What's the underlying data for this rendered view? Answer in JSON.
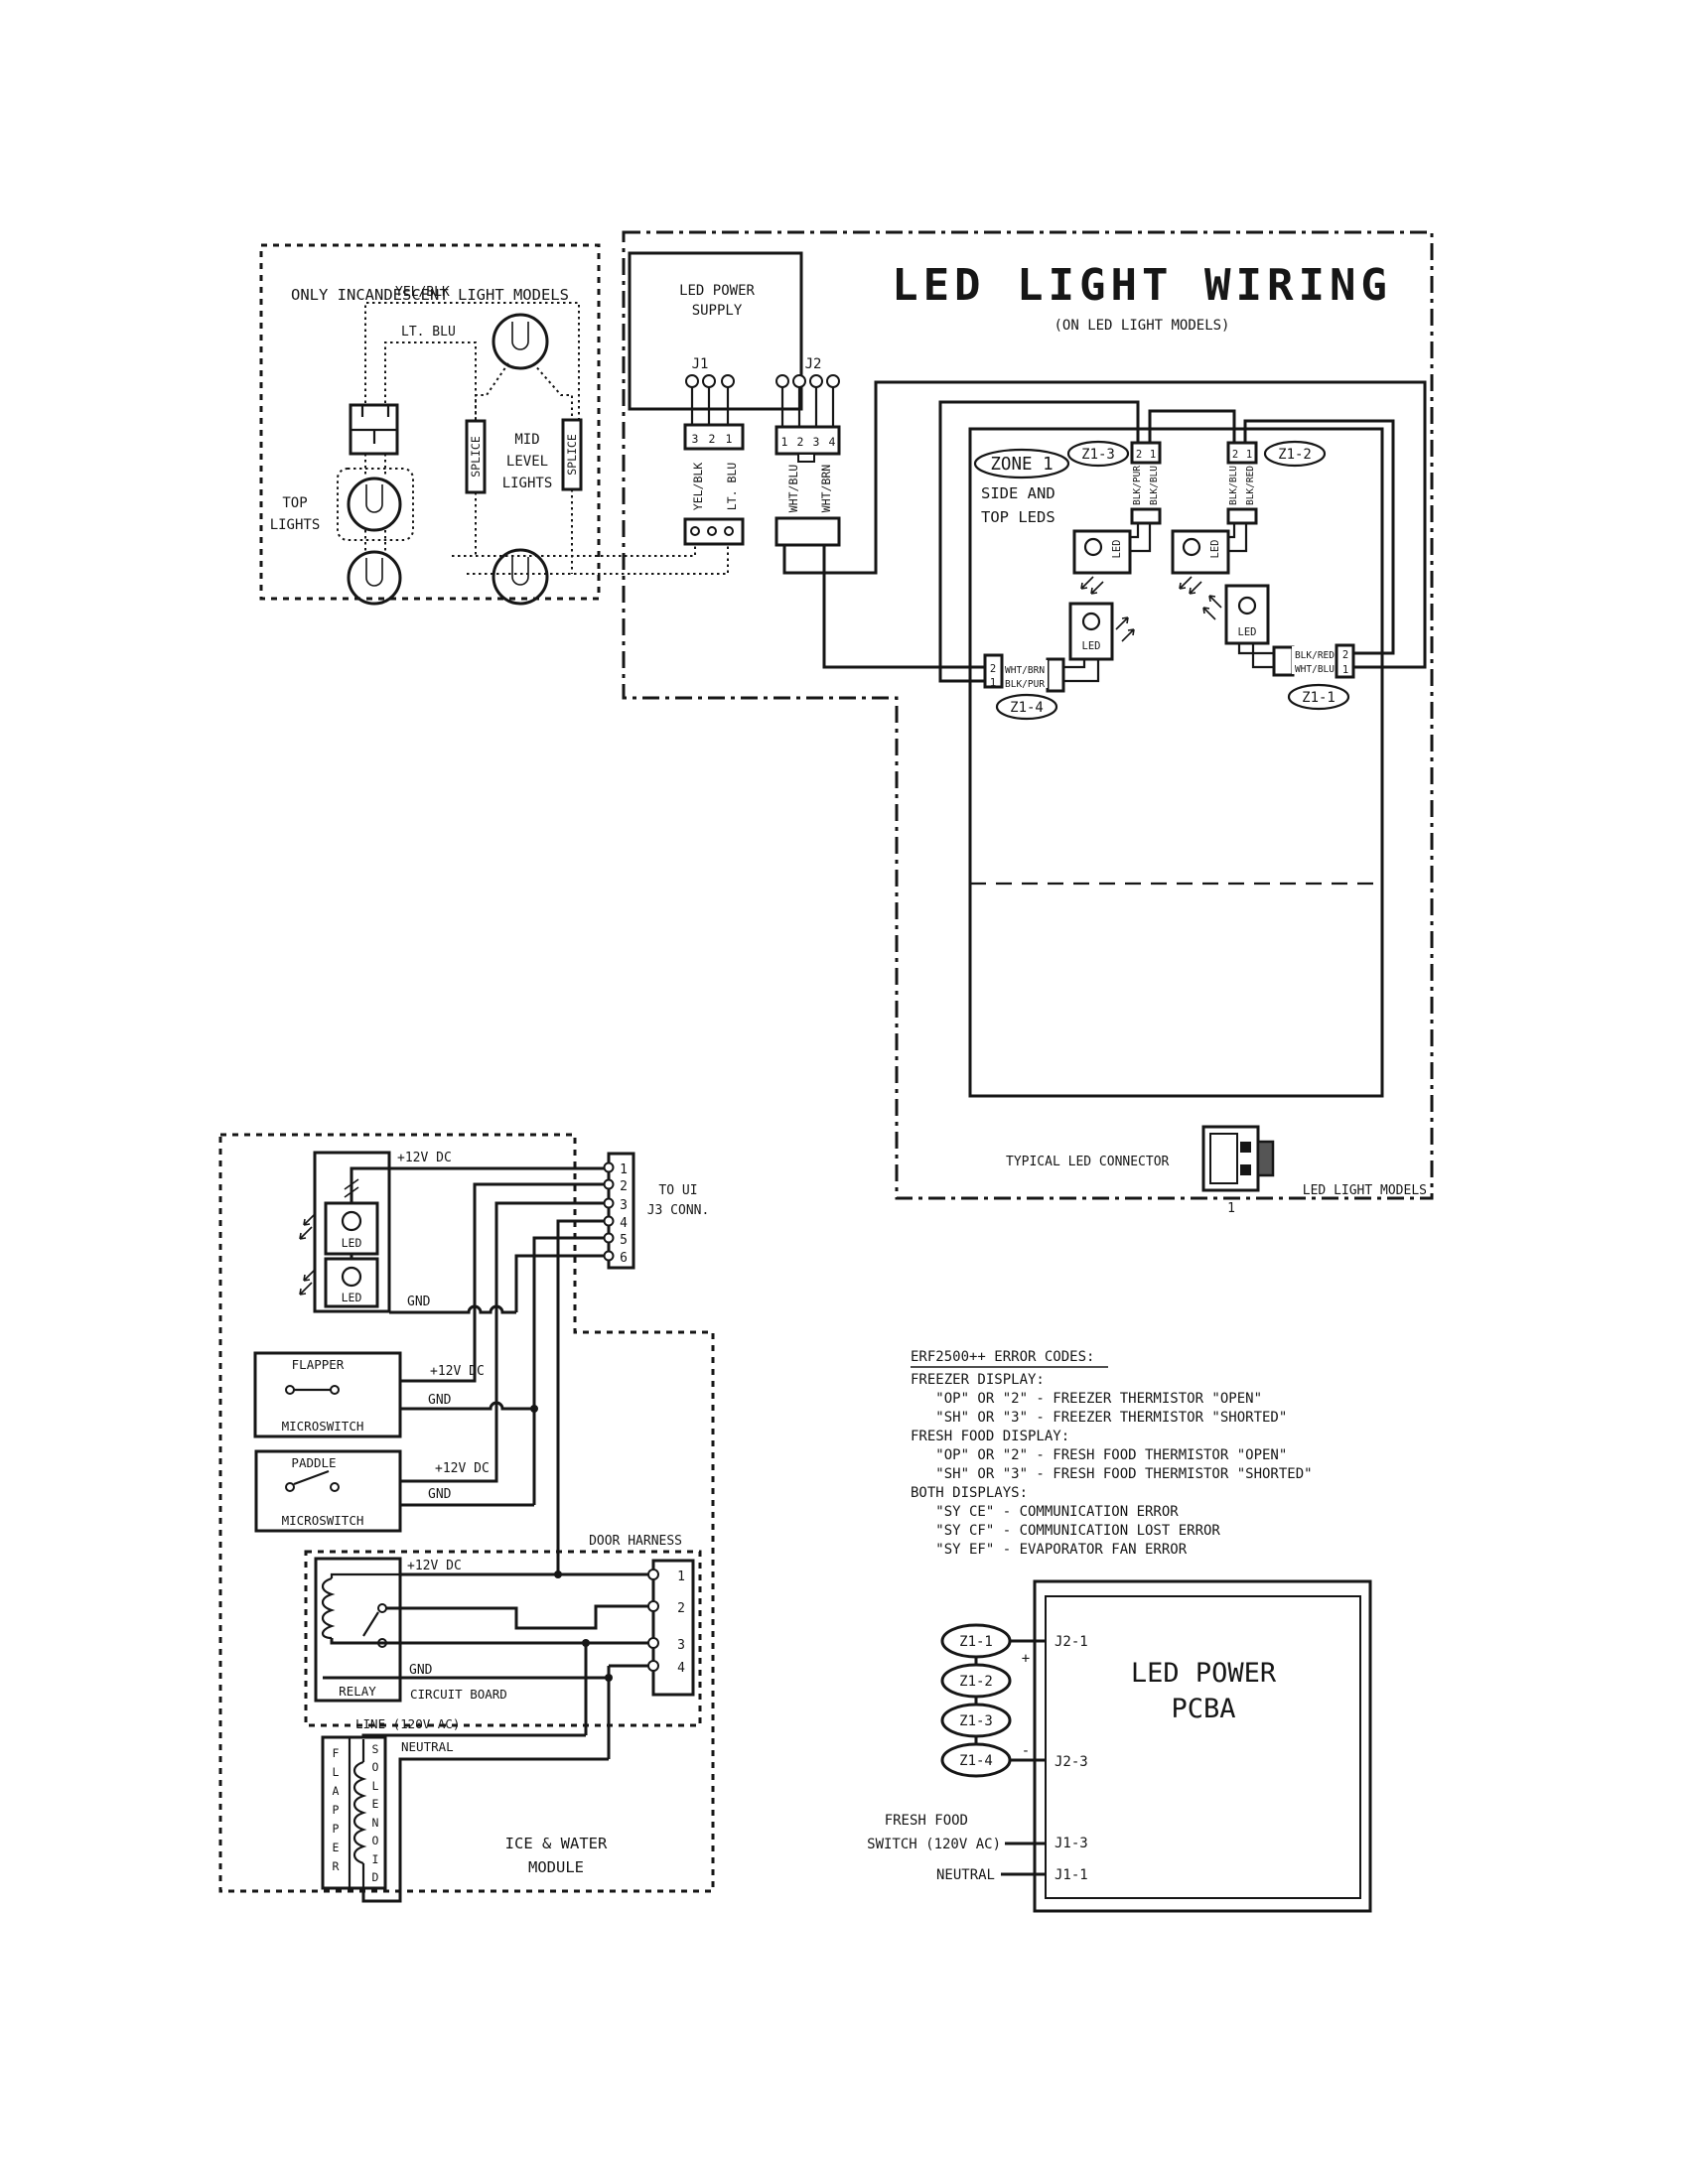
{
  "incandescent": {
    "title": "ONLY INCANDESCENT LIGHT MODELS",
    "yel_blk": "YEL/BLK",
    "lt_blu": "LT. BLU",
    "top_1": "TOP",
    "top_2": "LIGHTS",
    "mid_1": "MID",
    "mid_2": "LEVEL",
    "mid_3": "LIGHTS",
    "splice": "SPLICE"
  },
  "led_wiring": {
    "title": "LED LIGHT WIRING",
    "subtitle": "(ON LED LIGHT MODELS)",
    "supply_1": "LED POWER",
    "supply_2": "SUPPLY",
    "j1": "J1",
    "j2": "J2",
    "j1_pin3": "3",
    "j1_pin2": "2",
    "j1_pin1": "1",
    "j2_pin1": "1",
    "j2_pin2": "2",
    "j2_pin3": "3",
    "j2_pin4": "4",
    "j1_wire_a": "YEL/BLK",
    "j1_wire_b": "LT. BLU",
    "j2_wire_a": "WHT/BLU",
    "j2_wire_b": "WHT/BRN",
    "zone_label": "ZONE 1",
    "zone_desc_1": "SIDE AND",
    "zone_desc_2": "TOP LEDS",
    "z13": "Z1-3",
    "z12": "Z1-2",
    "z14": "Z1-4",
    "z11": "Z1-1",
    "pin2": "2",
    "pin1": "1",
    "z13_w2": "BLK/PUR",
    "z13_w1": "BLK/BLU",
    "z12_w2": "BLK/BLU",
    "z12_w1": "BLK/RED",
    "z14_w2": "WHT/BRN",
    "z14_w1": "BLK/PUR",
    "z11_w2": "BLK/RED",
    "z11_w1": "WHT/BLU",
    "led": "LED",
    "typ_conn": "TYPICAL LED CONNECTOR",
    "typ_conn_pin": "1",
    "footer": "LED LIGHT MODELS"
  },
  "ice_water": {
    "v12": "+12V DC",
    "gnd": "GND",
    "led": "LED",
    "ui_1": "TO UI",
    "ui_2": "J3 CONN.",
    "ui_pins": [
      "1",
      "2",
      "3",
      "4",
      "5",
      "6"
    ],
    "flapper": "FLAPPER",
    "paddle": "PADDLE",
    "microswitch": "MICROSWITCH",
    "door_harness": "DOOR HARNESS",
    "relay": "RELAY",
    "circuit_board": "CIRCUIT BOARD",
    "door_pins": [
      "1",
      "2",
      "3",
      "4"
    ],
    "line": "LINE (120V AC)",
    "neutral": "NEUTRAL",
    "flapper_v": [
      "F",
      "L",
      "A",
      "P",
      "P",
      "E",
      "R"
    ],
    "solenoid_v": [
      "S",
      "O",
      "L",
      "E",
      "N",
      "O",
      "I",
      "D"
    ],
    "module_1": "ICE & WATER",
    "module_2": "MODULE"
  },
  "error_codes": {
    "title": "ERF2500++ ERROR CODES:",
    "lines": [
      "FREEZER DISPLAY:",
      "   \"OP\" OR \"2\" - FREEZER THERMISTOR \"OPEN\"",
      "   \"SH\" OR \"3\" - FREEZER THERMISTOR \"SHORTED\"",
      "FRESH FOOD DISPLAY:",
      "   \"OP\" OR \"2\" - FRESH FOOD THERMISTOR \"OPEN\"",
      "   \"SH\" OR \"3\" - FRESH FOOD THERMISTOR \"SHORTED\"",
      "BOTH DISPLAYS:",
      "   \"SY CE\" - COMMUNICATION ERROR",
      "   \"SY CF\" - COMMUNICATION LOST ERROR",
      "   \"SY EF\" - EVAPORATOR FAN ERROR"
    ]
  },
  "pcba": {
    "title_1": "LED POWER",
    "title_2": "PCBA",
    "z11": "Z1-1",
    "z12": "Z1-2",
    "z13": "Z1-3",
    "z14": "Z1-4",
    "plus": "+",
    "minus": "-",
    "j21": "J2-1",
    "j23": "J2-3",
    "j13": "J1-3",
    "j11": "J1-1",
    "fresh_1": "FRESH FOOD",
    "fresh_2": "SWITCH (120V AC)",
    "neutral": "NEUTRAL"
  }
}
